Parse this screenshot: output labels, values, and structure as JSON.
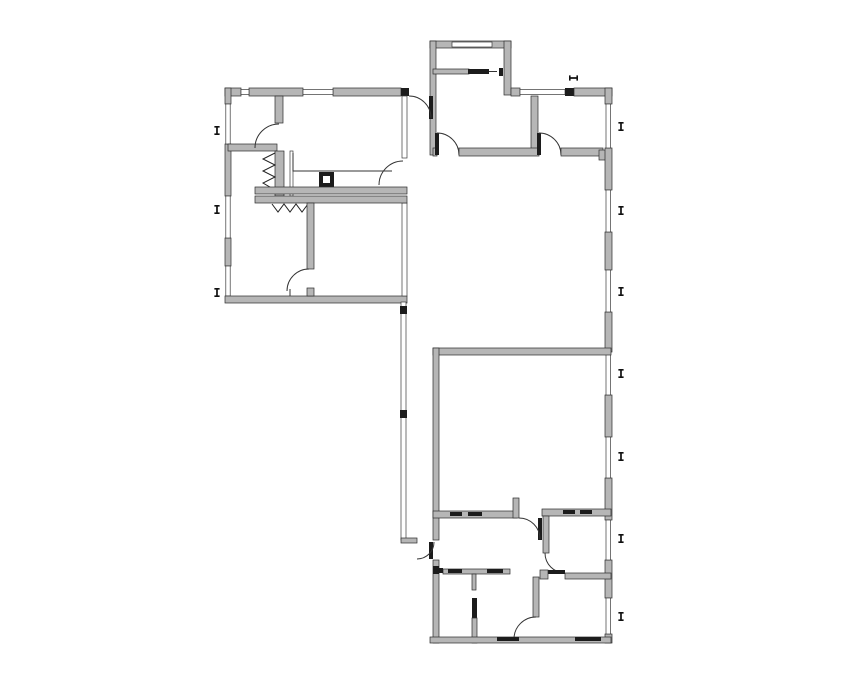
{
  "canvas": {
    "width": 855,
    "height": 678,
    "background": "#ffffff"
  },
  "palette": {
    "wall_fill": "#b6b6b6",
    "wall_stroke": "#2b2b2b",
    "door_leaf": "#1c1c1c",
    "window_fill": "#ffffff",
    "marker_color": "#111111"
  },
  "drawing": {
    "kind": "architectural floor plan",
    "rooms_visible": 12,
    "door_swings_visible": 10
  },
  "window_markers": {
    "glyph": "I",
    "items": [
      {
        "side": "left",
        "x": 217,
        "y": 131,
        "orientation": "vertical"
      },
      {
        "side": "left",
        "x": 217,
        "y": 210,
        "orientation": "vertical"
      },
      {
        "side": "left",
        "x": 217,
        "y": 293,
        "orientation": "vertical"
      },
      {
        "side": "top",
        "x": 573,
        "y": 78,
        "orientation": "horizontal"
      },
      {
        "side": "right",
        "x": 621,
        "y": 127,
        "orientation": "vertical"
      },
      {
        "side": "right",
        "x": 621,
        "y": 211,
        "orientation": "vertical"
      },
      {
        "side": "right",
        "x": 621,
        "y": 292,
        "orientation": "vertical"
      },
      {
        "side": "right",
        "x": 621,
        "y": 374,
        "orientation": "vertical"
      },
      {
        "side": "right",
        "x": 621,
        "y": 457,
        "orientation": "vertical"
      },
      {
        "side": "right",
        "x": 621,
        "y": 539,
        "orientation": "vertical"
      },
      {
        "side": "right",
        "x": 621,
        "y": 617,
        "orientation": "vertical"
      }
    ]
  }
}
